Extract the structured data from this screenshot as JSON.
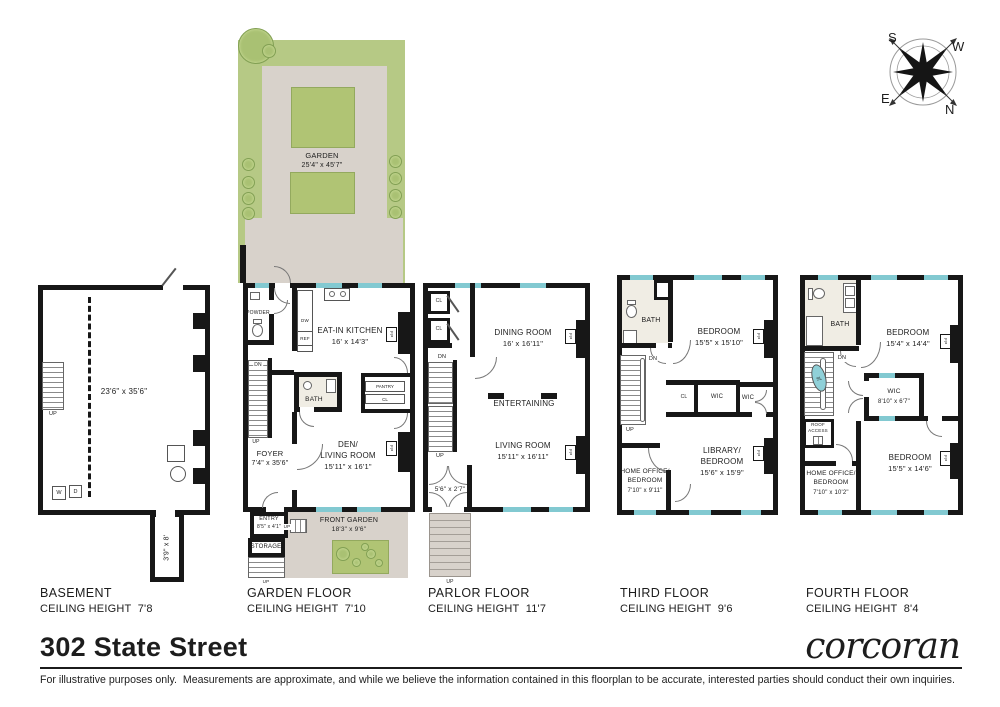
{
  "footer": {
    "title": "302 State Street",
    "brand": "corcoran",
    "disclaimer": "For illustrative purposes only.  Measurements are approximate, and while we believe the information contained in this floorplan to be accurate, interested parties should conduct their own inquiries."
  },
  "compass": {
    "n": "N",
    "s": "S",
    "e": "E",
    "w": "W"
  },
  "garden_plot": {
    "name": "GARDEN",
    "dims": "25'4\" x 45'7\""
  },
  "floor_titles": [
    {
      "name": "BASEMENT",
      "ceiling": "CEILING HEIGHT  7'8"
    },
    {
      "name": "GARDEN FLOOR",
      "ceiling": "CEILING HEIGHT  7'10"
    },
    {
      "name": "PARLOR FLOOR",
      "ceiling": "CEILING HEIGHT  11'7"
    },
    {
      "name": "THIRD FLOOR",
      "ceiling": "CEILING HEIGHT  9'6"
    },
    {
      "name": "FOURTH FLOOR",
      "ceiling": "CEILING HEIGHT  8'4"
    }
  ],
  "basement": {
    "room_dims": "23'6\" x 35'6\"",
    "ext_dims": "3'9\" x 8'",
    "up": "UP",
    "washer": "W",
    "dryer": "D"
  },
  "garden_floor": {
    "powder": "POWDER",
    "dw": "DW",
    "ref": "REF",
    "kitchen": "EAT-IN KITCHEN",
    "kitchen_dims": "16' x 14'3\"",
    "bath": "BATH",
    "pantry": "PANTRY",
    "cl": "CL",
    "foyer": "FOYER",
    "foyer_dims": "7'4\" x 35'6\"",
    "den": "DEN/\nLIVING ROOM",
    "den_dims": "15'11\" x 16'1\"",
    "entry": "ENTRY",
    "entry_dims": "8'5\" x 4'1\"",
    "storage": "STORAGE",
    "front_garden": "FRONT GARDEN",
    "front_garden_dims": "18'3\" x 9'6\"",
    "fp": "FP",
    "dn": "DN",
    "up": "UP"
  },
  "parlor": {
    "cl": "CL",
    "dining": "DINING ROOM",
    "dining_dims": "16' x 16'11\"",
    "entertaining": "ENTERTAINING",
    "living": "LIVING ROOM",
    "living_dims": "15'11\" x 16'11\"",
    "vestibule_dims": "5'6\" x 2'7\"",
    "fp": "FP",
    "dn": "DN",
    "up": "UP"
  },
  "third": {
    "bath": "BATH",
    "bedroom": "BEDROOM",
    "bedroom_dims": "15'5\" x 15'10\"",
    "cl": "CL",
    "wic": "WIC",
    "home_office": "HOME OFFICE/\nBEDROOM",
    "home_office_dims": "7'10\" x 9'11\"",
    "library": "LIBRARY/\nBEDROOM",
    "library_dims": "15'6\" x 15'9\"",
    "fp": "FP",
    "dn": "DN",
    "up": "UP"
  },
  "fourth": {
    "bath": "BATH",
    "bedroom1": "BEDROOM",
    "bedroom1_dims": "15'4\" x 14'4\"",
    "wic": "WIC",
    "wic_dims": "8'10\" x 6'7\"",
    "sl": "SL",
    "roof_access": "ROOF\nACCESS",
    "home_office": "HOME OFFICE/\nBEDROOM",
    "home_office_dims": "7'10\" x 10'2\"",
    "bedroom2": "BEDROOM",
    "bedroom2_dims": "15'5\" x 14'6\"",
    "fp": "FP",
    "dn": "DN"
  },
  "colors": {
    "wall": "#171717",
    "window": "#82c9d1",
    "grass": "#b6c985",
    "lawn": "#b0c474",
    "patio": "#d8d2cb",
    "bath_floor": "#f0ede4",
    "skylight": "#8fd0d8"
  }
}
